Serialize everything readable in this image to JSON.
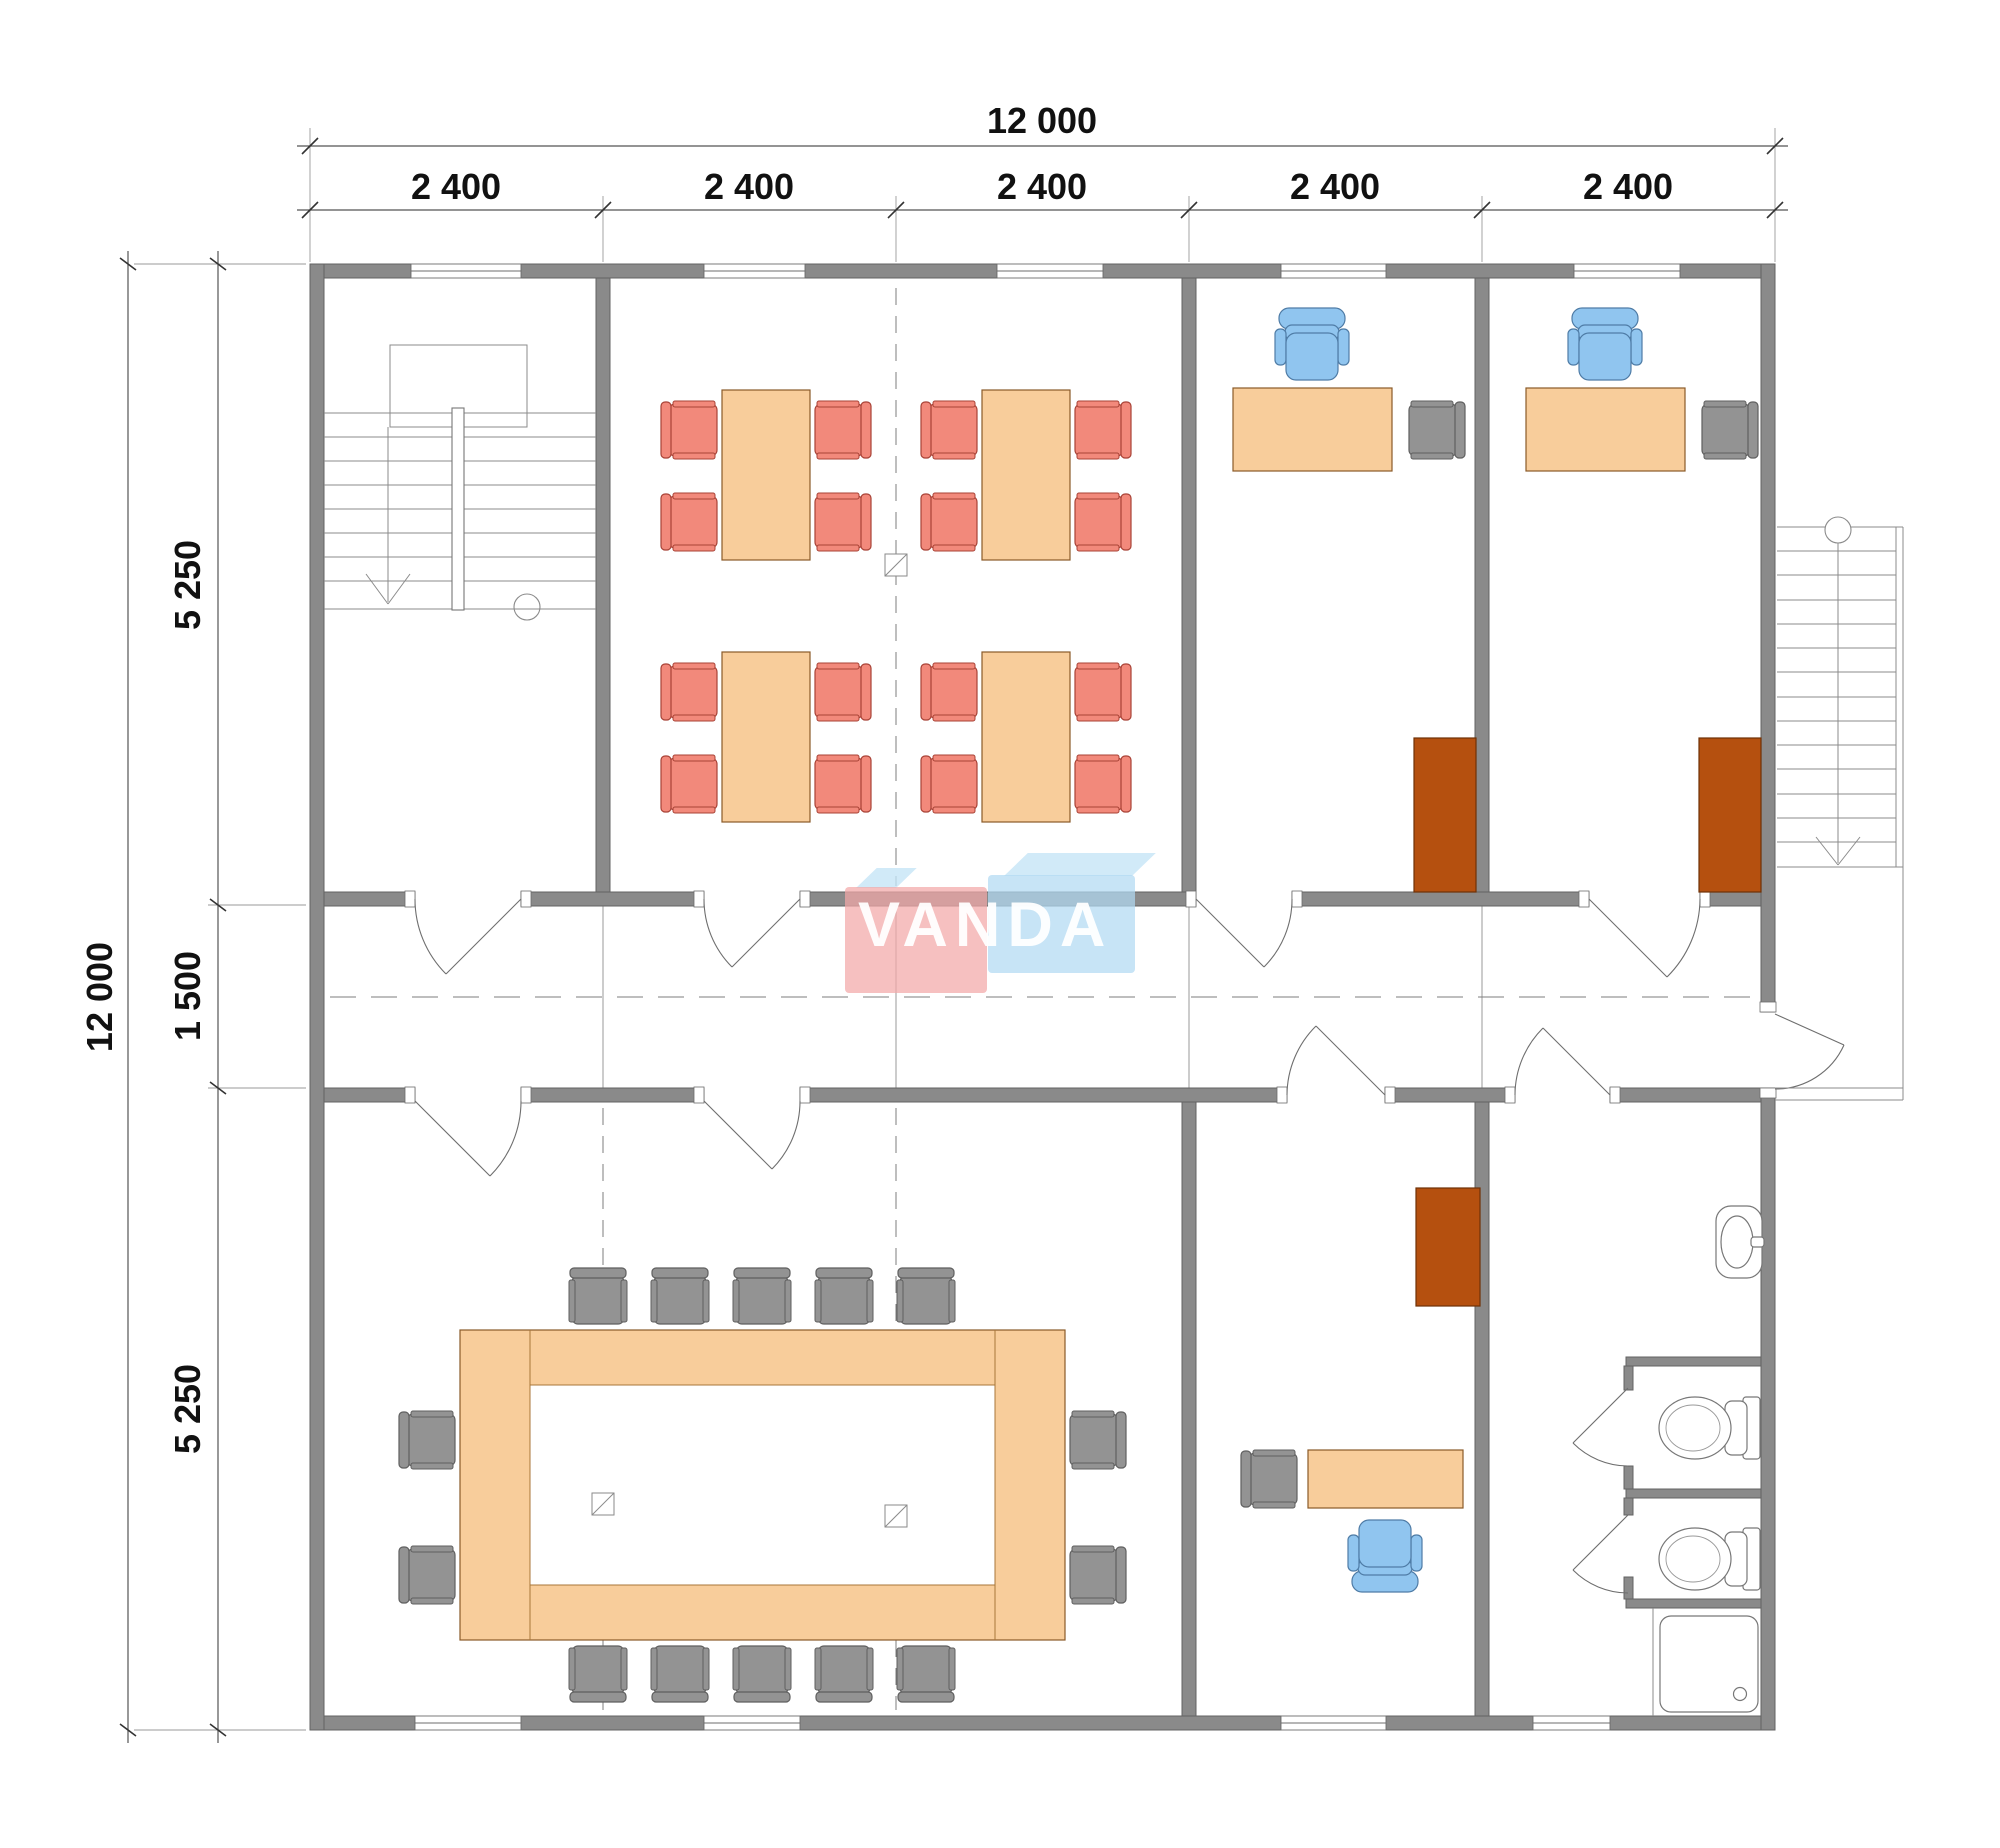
{
  "watermark": {
    "text": "VANDA"
  },
  "dimensions": {
    "top_total": "12 000",
    "top_segments": [
      "2 400",
      "2 400",
      "2 400",
      "2 400",
      "2 400"
    ],
    "left_total": "12 000",
    "left_segments": [
      "5 250",
      "1 500",
      "5 250"
    ]
  },
  "palette": {
    "wall": "#8a8a8a",
    "wood": "#f8cd9b",
    "chair_red": "#f2897b",
    "chair_red_edge": "#a84236",
    "chair_blue": "#90c5ef",
    "chair_blue_edge": "#4f7ca6",
    "chair_gray": "#939393",
    "chair_gray_edge": "#5f5f5f",
    "cabinet": "#b5500f",
    "logo_pink": "#f3a7a7",
    "logo_blue": "#b2daf2"
  }
}
